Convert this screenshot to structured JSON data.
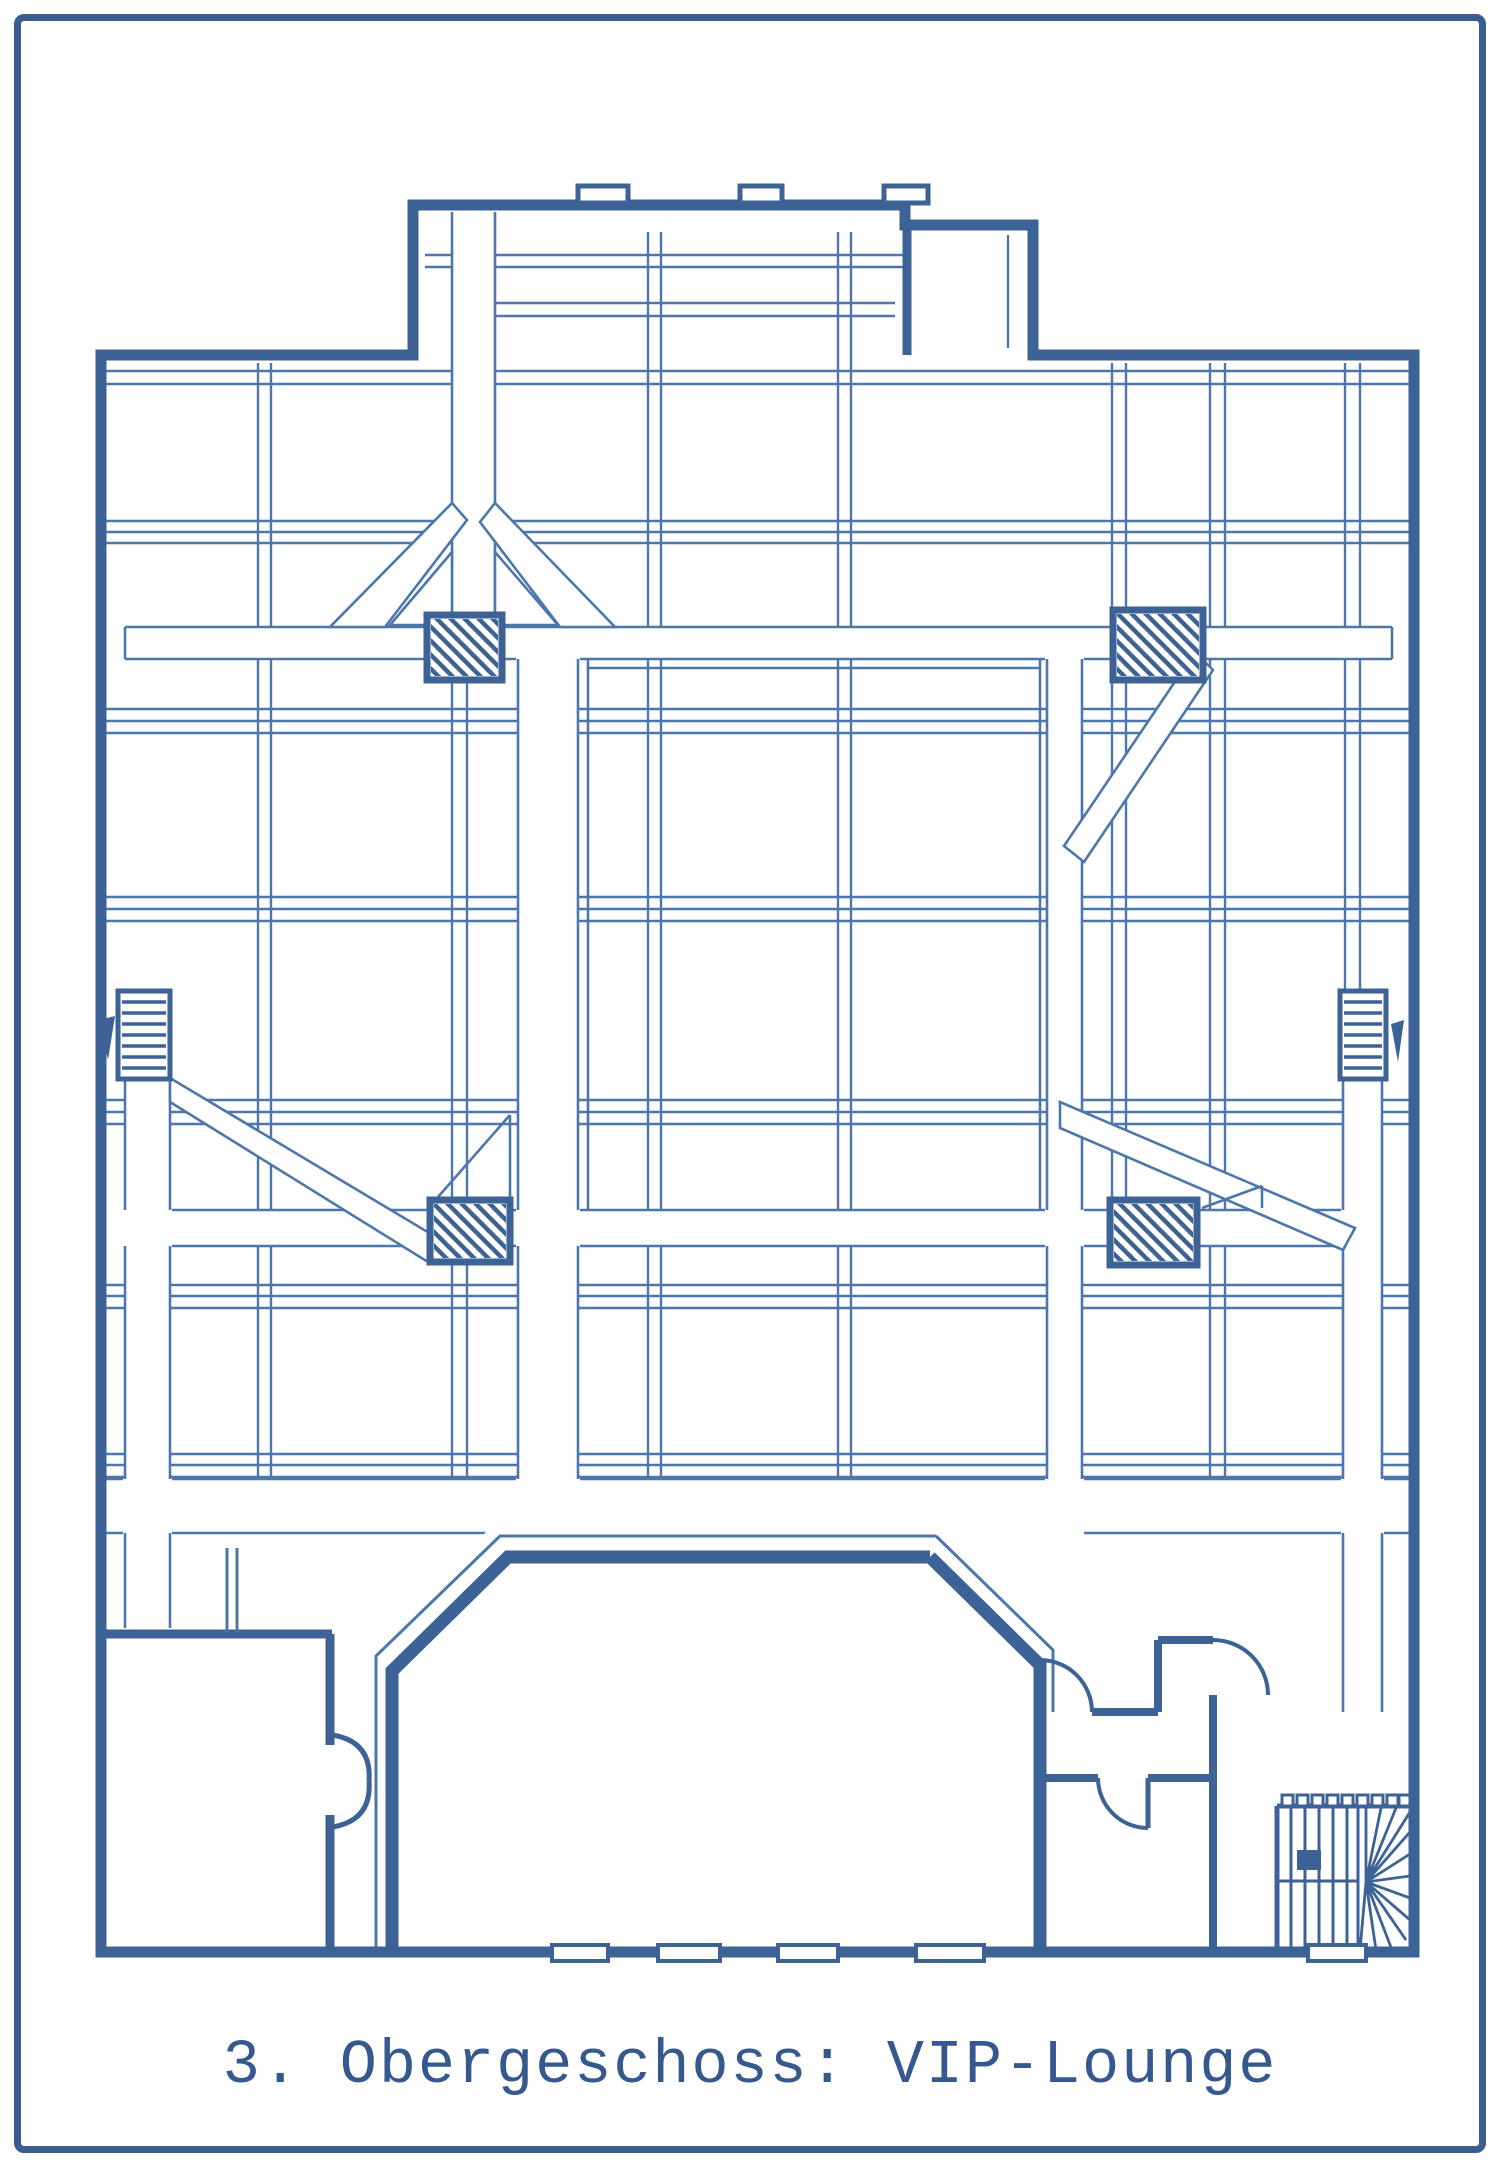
{
  "caption": {
    "text": "3. Obergeschoss: VIP-Lounge",
    "color": "#35598e"
  },
  "page": {
    "background": "#ffffff",
    "border_color": "#3a5d90"
  },
  "drawing": {
    "kind": "scanned blueprint floor plan",
    "ink_color": "#3c6296",
    "thin_line_color": "#4d76ab",
    "depicted_elements": [
      "outer building walls with top bay",
      "window / skylight mullion grid",
      "white circulation corridors with diagonal braces",
      "4 hatched columns",
      "2 wall ladders with direction arrows",
      "central VIP lounge hall (elongated hexagon)",
      "bottom rooms with door swing arcs",
      "winder stair bottom right"
    ]
  }
}
